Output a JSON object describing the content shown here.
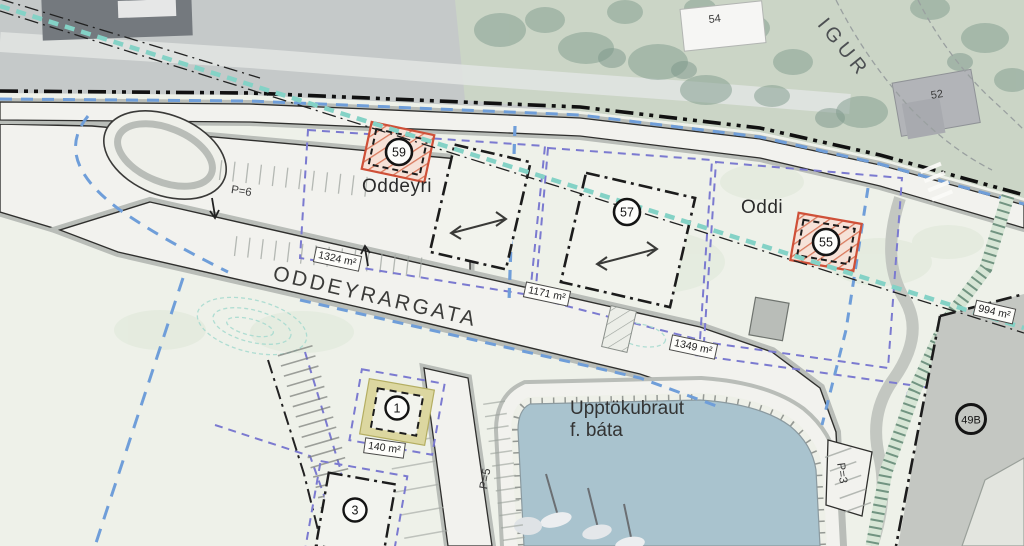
{
  "plan": {
    "street_label": "ODDEYRARGATA",
    "street_label_partial": "IGUR",
    "area_label_west": "Oddeyri",
    "area_label_east": "Oddi",
    "slipway_label_line1": "Upptökubraut",
    "slipway_label_line2": "f. báta",
    "parking_labels": {
      "p6": "P=6",
      "p5": "P=5",
      "p3": "P=3"
    },
    "plot_circles": {
      "c59": "59",
      "c57": "57",
      "c55": "55",
      "c1": "1",
      "c3": "3",
      "c49b": "49B"
    },
    "aerial_building_numbers": {
      "b54": "54",
      "b52": "52"
    },
    "area_sizes": {
      "a1324": "1324 m²",
      "a1171": "1171 m²",
      "a1349": "1349 m²",
      "a994": "994 m²",
      "a140": "140 m²"
    },
    "colors": {
      "plan_background": "#eef1e9",
      "aerial_gray": "#c5c9c9",
      "aerial_green": "#cbd5c6",
      "paved": "#f2f2ee",
      "verge_gray": "#b9bdb8",
      "water": "#a9c3ce",
      "boundary_blue": "#6f9ed9",
      "boundary_purple": "#7b7ad0",
      "utility_teal": "#84d2c6",
      "building_hatch_red": "#cf5038",
      "plot_yellow": "#dcd7a0",
      "existing_plot_gray": "#c4c7c2"
    }
  }
}
